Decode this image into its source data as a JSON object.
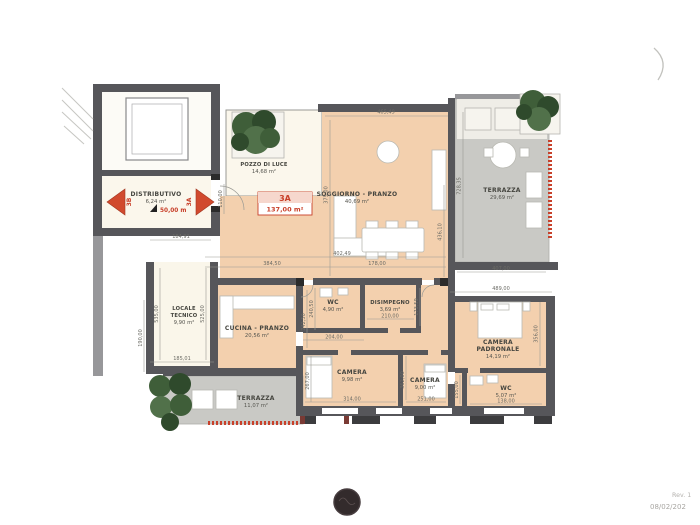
{
  "drawing": {
    "unit": {
      "code": "3A",
      "area": "137,00 m²"
    },
    "access": {
      "left_unit": "3B",
      "right_unit": "3A",
      "elevation": "50,00 m"
    },
    "rooms": {
      "distributivo": {
        "name": "DISTRIBUTIVO",
        "area": "6,24 m²"
      },
      "pozzo_di_luce": {
        "name": "POZZO DI LUCE",
        "area": "14,68 m²"
      },
      "soggiorno": {
        "name": "SOGGIORNO - PRANZO",
        "area": "40,69 m²"
      },
      "terrazza_est": {
        "name": "TERRAZZA",
        "area": "29,69 m²"
      },
      "locale_tecnico": {
        "name1": "LOCALE",
        "name2": "TECNICO",
        "area": "9,90 m²"
      },
      "cucina": {
        "name": "CUCINA - PRANZO",
        "area": "20,56 m²"
      },
      "wc_1": {
        "name": "WC",
        "area": "4,90 m²"
      },
      "disimpegno": {
        "name": "DISIMPEGNO",
        "area": "3,69 m²"
      },
      "camera_1": {
        "name": "CAMERA",
        "area": "9,98 m²"
      },
      "camera_2": {
        "name": "CAMERA",
        "area": "9,00 m²"
      },
      "camera_padronale": {
        "name1": "CAMERA",
        "name2": "PADRONALE",
        "area": "14,19 m²"
      },
      "wc_2": {
        "name": "WC",
        "area": "5,07 m²"
      },
      "terrazza_sud": {
        "name": "TERRAZZA",
        "area": "11,07 m²"
      }
    },
    "dims": {
      "sog_top": "465,49",
      "sog_left": "375,00",
      "sog_right": "436,10",
      "ter_left": "728,35",
      "ter_bottom": "407,00",
      "pad_top": "489,00",
      "pad_right": "356,00",
      "mid_1": "184,91",
      "mid_2": "402,49",
      "mid_3": "384,50",
      "mid_4": "178,00",
      "lt_left": "535,00",
      "lt_right": "525,00",
      "lt_gap": "190,00",
      "lt_bottom": "185,01",
      "wc1_left_a": "240,50",
      "wc1_left_b": "242,50",
      "wc1_bottom": "204,00",
      "dis_bottom": "210,00",
      "dis_right": "173,59",
      "cam1_left": "267,00",
      "cam1_bottom": "314,00",
      "cam2_left": "362,00",
      "cam2_bottom": "251,00",
      "wc2_left": "155,00",
      "wc2_bottom": "138,00",
      "door_right": "110,00"
    },
    "colors": {
      "accent_red": "#c8402a",
      "room_fill": "#f3d0ae",
      "terrace_fill": "#c9c9c5",
      "wall": "#56565a",
      "court_fill": "#fbf7ec",
      "tree": "#3f5a3a"
    }
  },
  "titleblock": {
    "rev": "Rev. 1",
    "date": "08/02/202"
  }
}
